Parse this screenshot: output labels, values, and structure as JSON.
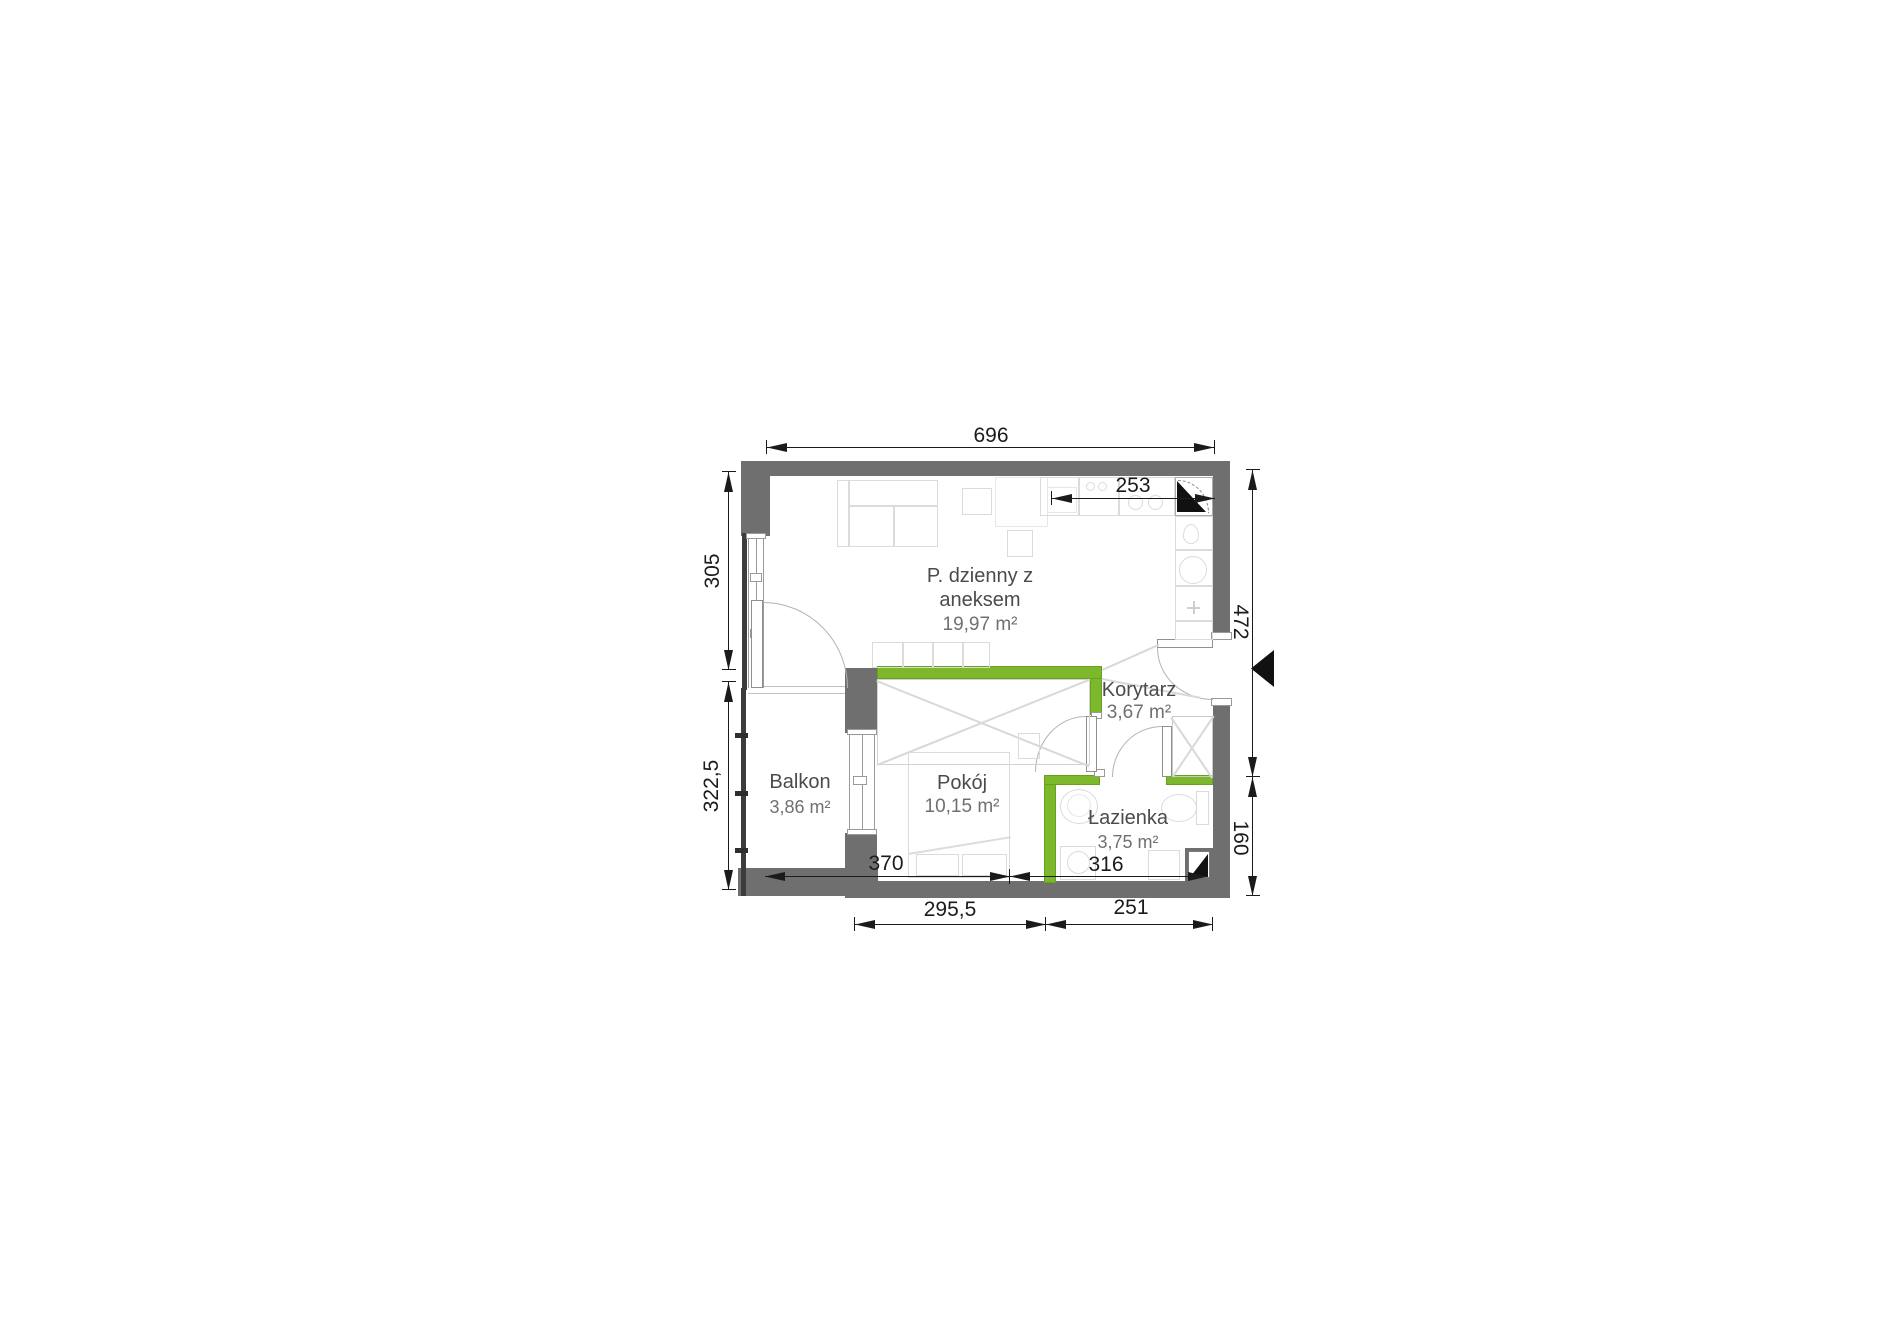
{
  "plan": {
    "rooms": {
      "living": {
        "name": "P. dzienny z aneksem",
        "area": "19,97 m²"
      },
      "korytarz": {
        "name": "Korytarz",
        "area": "3,67 m²"
      },
      "pokoj": {
        "name": "Pokój",
        "area": "10,15 m²"
      },
      "lazienka": {
        "name": "Łazienka",
        "area": "3,75 m²"
      },
      "balkon": {
        "name": "Balkon",
        "area": "3,86 m²"
      }
    },
    "dimensions": {
      "top_width": "696",
      "kitchen_width": "253",
      "left_upper": "305",
      "left_lower": "322,5",
      "right_upper": "472",
      "right_lower": "160",
      "inner_room": "370",
      "inner_bath": "316",
      "bottom_left": "295,5",
      "bottom_right": "251"
    },
    "colors": {
      "wall_gray": "#6f6f6f",
      "accent_green": "#7cb72c"
    }
  }
}
